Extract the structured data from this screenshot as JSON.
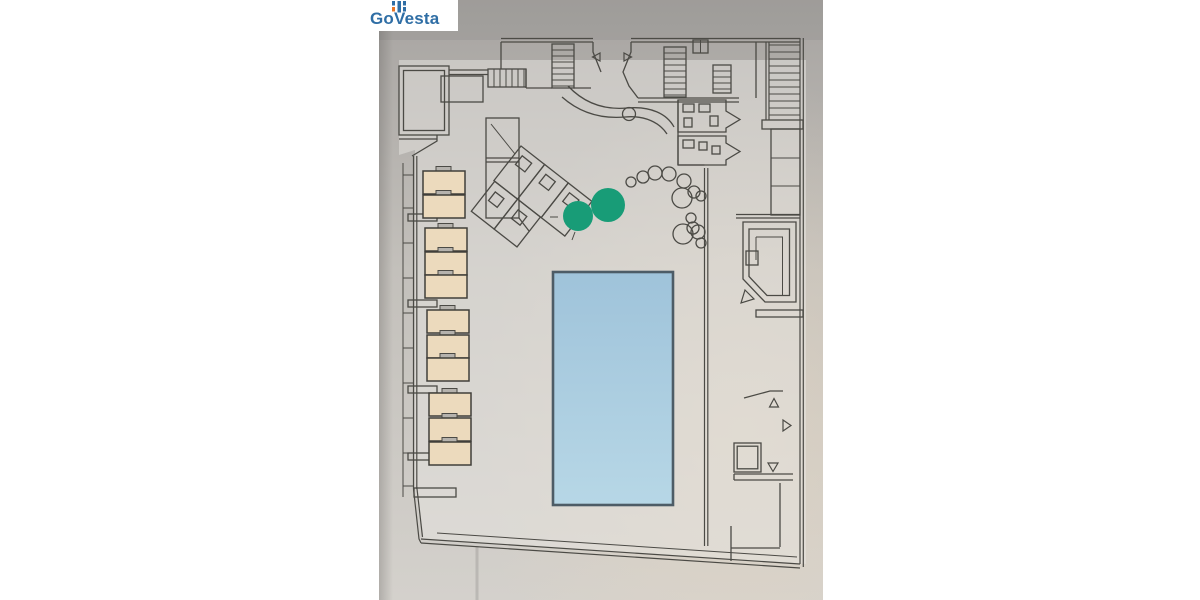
{
  "window": {
    "width": 1200,
    "height": 600,
    "background": "#ffffff"
  },
  "logo": {
    "text": "GoVesta",
    "text_color": "#2f6ea5",
    "icon": {
      "name": "govesta-blocks-icon",
      "blue": "#2f6ea5",
      "orange": "#e87425"
    },
    "background": "#ffffff"
  },
  "photo": {
    "description": "photographed architectural floor plan of a pool terrace level",
    "background_top": "#a7a4a1",
    "background_mid": "#c3c0bb",
    "background_bottom": "#d4d1cc",
    "line_color": "#4b4a45"
  },
  "floor_plan": {
    "pool": {
      "label": "swimming-pool",
      "fill_top": "#9fc3da",
      "fill_bottom": "#b7d7e6",
      "border": "#4d5c66"
    },
    "loungers": {
      "count": 11,
      "fill": "#ecdabd",
      "border": "#403f3a"
    },
    "trees": {
      "count": 2,
      "fill": "#189c77"
    },
    "plants": {
      "count": 13
    },
    "door_markers": {
      "count": 6
    },
    "staircases": {
      "count": 4
    }
  }
}
